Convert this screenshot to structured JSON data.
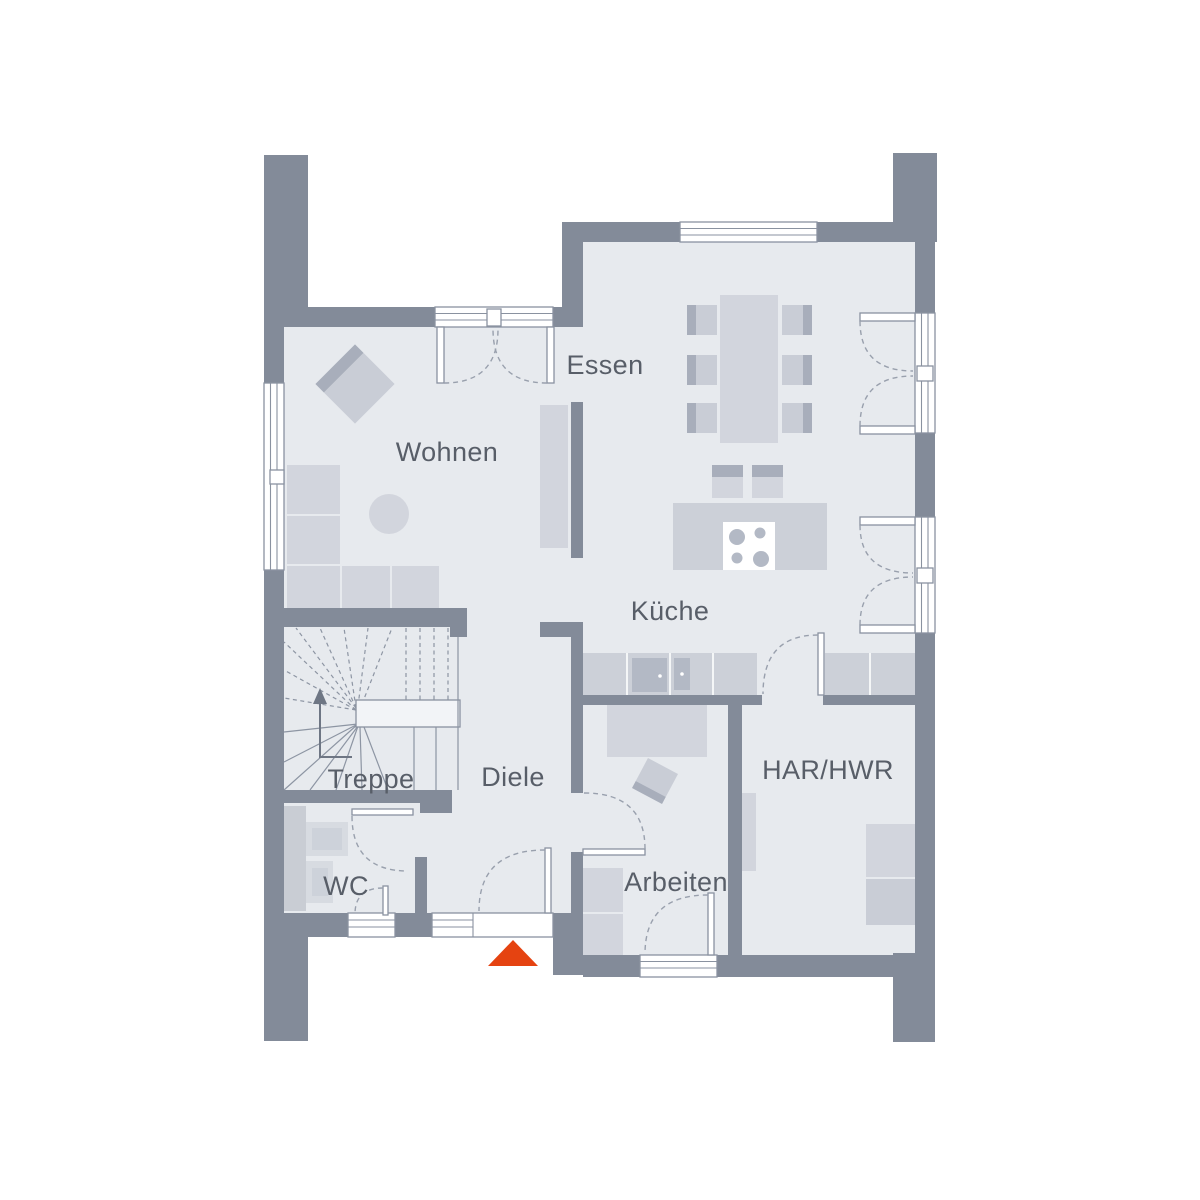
{
  "colors": {
    "background": "#ffffff",
    "wall": "#838b99",
    "floor": "#e7eaee",
    "furniture": "#d2d5dd",
    "furniture_mid": "#c9cdd6",
    "furniture_dark": "#a8aebb",
    "counter": "#ccd0d8",
    "appliance": "#b3b9c5",
    "frame": "#8a92a0",
    "stair_line": "#8d95a3",
    "label": "#585e68",
    "accent": "#e54311"
  },
  "plan": {
    "type": "floor-plan",
    "rooms": [
      {
        "id": "essen",
        "label": "Essen"
      },
      {
        "id": "wohnen",
        "label": "Wohnen"
      },
      {
        "id": "kueche",
        "label": "Küche"
      },
      {
        "id": "treppe",
        "label": "Treppe"
      },
      {
        "id": "diele",
        "label": "Diele"
      },
      {
        "id": "wc",
        "label": "WC"
      },
      {
        "id": "arbeiten",
        "label": "Arbeiten"
      },
      {
        "id": "har_hwr",
        "label": "HAR/HWR"
      }
    ],
    "entrance_marker": {
      "shape": "triangle",
      "color": "#e54311"
    }
  }
}
